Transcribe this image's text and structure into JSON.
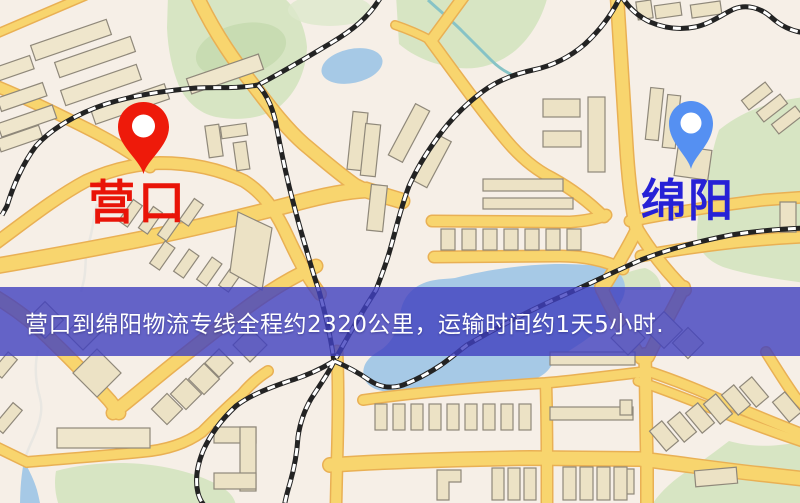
{
  "banner": {
    "text": "营口到绵阳物流专线全程约2320公里，运输时间约1天5小时.",
    "background_color": "#4040bf",
    "text_color": "#ffffff"
  },
  "markers": {
    "origin": {
      "label": "营口",
      "label_color": "#e91408",
      "pin_color": "#ee1a0a"
    },
    "destination": {
      "label": "绵阳",
      "label_color": "#2621d6",
      "pin_color": "#5590f2"
    }
  },
  "map_palette": {
    "background": "#f6efe7",
    "road_fill": "#f8d56e",
    "road_casing": "#e9b054",
    "building_fill": "#ece2c5",
    "building_stroke": "#8f887a",
    "park_green": "#d7e5c3",
    "water_blue": "#a6c9e6",
    "railway": "#232323"
  }
}
